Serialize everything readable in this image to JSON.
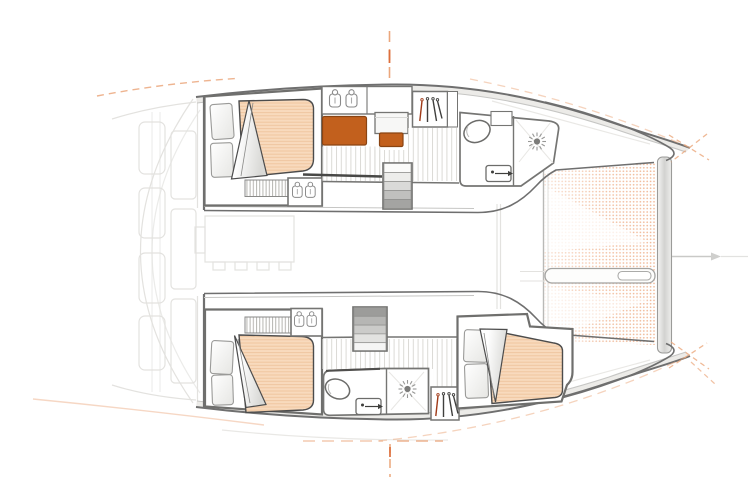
{
  "document": {
    "type": "catamaran-floor-plan",
    "description": "Top-down interior layout drawing of a sailing catamaran: two hulls with cabins and bathrooms, saloon ghost outline, bow trampoline, orange accent furniture, dashed centerline guides",
    "visible_text": []
  },
  "colors": {
    "background": "#ffffff",
    "hull_outline": "#6f6f6f",
    "hull_outline_light": "#c6c6c4",
    "wall": "#757573",
    "wall_band": "#eae9e6",
    "ghost": "#e3e2df",
    "floor_plank_line": "#dbdad6",
    "slat_line": "#b9b8b4",
    "mattress": "#f8dabd",
    "mattress_line": "#eec49d",
    "mattress_edge": "#4c4c4c",
    "accent_orange": "#c2601d",
    "accent_orange_dark": "#8a4412",
    "guide_orange": "#eba77c",
    "guide_orange_strong": "#dd6f3c",
    "trampoline_dot": "#f0b795",
    "stair_dark": "#9c9c9a",
    "icon_gray": "#8a8a8a",
    "icon_dark": "#3f3f3d",
    "hanger_red": "#a03a18",
    "handrail": "#484846",
    "axis_gray": "#c9c9c7"
  },
  "icons": {
    "basin": "sink-basin-icon",
    "washbasin": "washbasin-icon",
    "shower": "shower-drain-icon",
    "toilet": "toilet-icon",
    "hangers": "hanging-locker-icon",
    "stairs": "companionway-stairs",
    "bed": "double-bed",
    "trampoline": "trampoline-net",
    "bowsprit": "bowsprit-beam",
    "crossbeam": "forward-crossbeam",
    "centerline": "dashed-axis-guide"
  },
  "legend": {
    "double_beds": 3,
    "bathrooms": 2,
    "washbasins": 2,
    "showers": 2,
    "toilets": 2,
    "companionway_stairs": 2,
    "hanging_lockers": 2,
    "twin_basin_units": 3,
    "orange_modules": 2,
    "trampolines": 1
  }
}
